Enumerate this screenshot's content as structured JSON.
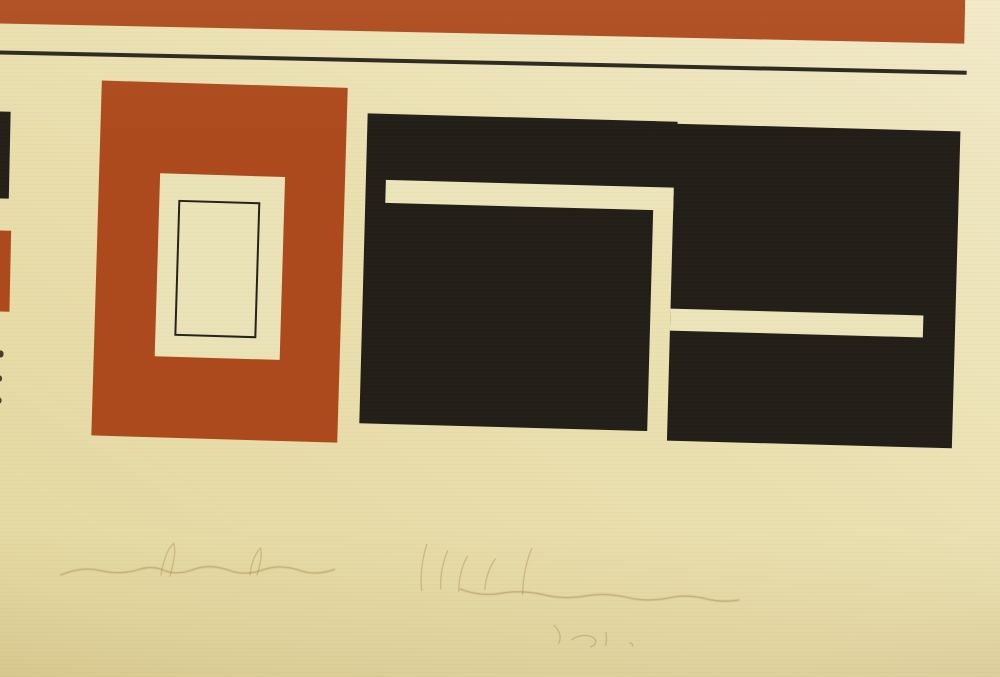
{
  "artwork": {
    "description": "photograph of an abstract geometric print: red bar and rule at top, red rectangle with nested cream and outlined rectangles, large black interlocking blocks with cream slots, faint illegible pencil inscriptions below",
    "palette": {
      "paper": "#eae0b0",
      "paper_light": "#f1e9c7",
      "paper_dark": "#e4d8a0",
      "print_red": "#ad4a1d",
      "print_black": "#221e18",
      "pencil": "#ab8c54"
    },
    "shapes": {
      "red_top_bar": {
        "style": "left:-40px;top:-40px;width:998px;height:74px;background:#ad4a1d;"
      },
      "black_rule": {
        "style": "left:-40px;top:61px;width:1001px;height:3.5px;background:#29251d;"
      },
      "left_black_fragment": {
        "style": "left:-12px;top:122px;width:18px;height:87px;background:#241f19;"
      },
      "left_red_fragment": {
        "style": "left:-12px;top:241px;width:21px;height:81px;background:#ad4a1d;"
      },
      "speck_1": {
        "style": "left:-2px;top:361px;width:6px;height:7px;background:#453c2c;border-radius:45%;"
      },
      "speck_2": {
        "style": "left:-2px;top:386px;width:5px;height:6px;background:#4a4130;border-radius:45%;"
      },
      "speck_3": {
        "style": "left:-2px;top:408px;width:5px;height:6px;background:#4a4130;border-radius:45%;"
      },
      "red_rect": {
        "style": "left:95px;top:90px;width:246px;height:355px;background:#ad4a1d;transform:rotate(0.5deg);"
      },
      "cream_window": {
        "style": "left:61px;top:91px;width:125px;height:183px;background:#ebe3b8;"
      },
      "outlined_rect": {
        "style": "left:19px;top:26px;width:78px;height:132px;border:2.5px solid #26221a;background:#ebe3b8;"
      },
      "black_group": {
        "style": "left:0;top:0;width:1000px;height:677px;transform:rotate(0.35deg);transform-origin:658px 282px;"
      },
      "left_black_block": {
        "style": "left:362px;top:118px;width:288px;height:310px;background:#221e18;"
      },
      "bridge_black_block": {
        "style": "left:648px;top:118px;width:24px;height:70px;background:#221e18;"
      },
      "right_black_block": {
        "style": "left:670px;top:120px;width:285px;height:317px;background:#221e18;"
      },
      "slot_a_cream": {
        "style": "left:382px;top:184px;width:288px;height:23px;background:#ece4ba;"
      },
      "slot_c_cream": {
        "style": "left:670px;top:305px;width:253px;height:22px;background:#ece4ba;"
      }
    },
    "inscriptions": {
      "note": "faint handwritten pencil inscriptions, illegible",
      "left_main": {
        "desc": "illegible pencil inscription (lower left)",
        "d": "M66 584 c14 -6 26 -8 40 -5 c14 3 26 2 38 -2 c8 -3 16 -3 24 0 c10 4 20 3 30 -1 c12 -5 24 -4 36 0 c12 4 24 3 36 -2 c12 -4 24 -3 36 1 c10 3 22 2 33 -2"
      },
      "left_ascenders": {
        "desc": "taller strokes in left inscription",
        "d": "M166 582 c2 -14 6 -26 12 -32 c3 8 0 22 -3 33 M255 580 c1 -12 5 -22 10 -27 c2 7 0 17 -3 27"
      },
      "right_tall": {
        "desc": "tall strokes of center inscription",
        "d": "M427 592 c-2 -16 0 -32 4 -46 M446 590 c-1 -14 2 -28 6 -38 M464 592 c0 -14 3 -26 8 -35 M490 590 c1 -13 5 -24 10 -31 M528 594 c0 -17 3 -33 8 -46"
      },
      "right_main": {
        "desc": "illegible pencil inscription (lower center)",
        "d": "M466 590 c14 5 28 6 42 3 c14 -3 28 -2 42 1 c14 3 28 3 42 0 c14 -3 28 -2 42 1 c14 3 28 2 42 -1 c12 -3 26 -2 38 1 c10 2 20 2 30 0"
      },
      "small_mark": {
        "desc": "short pencil mark below center inscription",
        "d": "M560 624 c6 6 8 12 5 18 M578 638 c8 -5 16 -6 22 -2 c4 3 2 7 -3 9 M612 630 c1 5 1 9 0 13 M636 640 c2 0 3 1 3 3"
      }
    }
  }
}
